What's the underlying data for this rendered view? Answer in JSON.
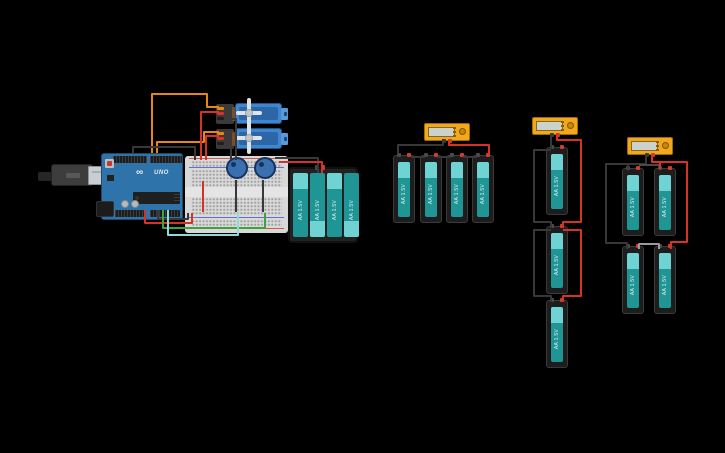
{
  "canvas": {
    "background": "#000000",
    "width": 725,
    "height": 453
  },
  "palette": {
    "wire_red": "#d63227",
    "wire_black": "#383838",
    "wire_orange": "#e8870e",
    "wire_green": "#3da43d",
    "wire_cyan": "#93d9d9",
    "wire_gray": "#9a9a9a",
    "wire_darkgray": "#4a4a4a",
    "board_blue": "#2e74ab",
    "battery_teal": "#1f9595",
    "battery_teal_light": "#6fd3d3",
    "multimeter_orange": "#f2a71d",
    "servo_blue": "#3e87cf",
    "breadboard_gray": "#d8d8d8"
  },
  "labels": {
    "battery": "AA 1.5V",
    "arduino_model": "UNO",
    "arduino_logo": "∞"
  },
  "components": {
    "arduino": {
      "name": "Arduino Uno R3",
      "model": "UNO"
    },
    "usb_cable": {
      "name": "USB cable"
    },
    "breadboard": {
      "name": "Small breadboard"
    },
    "servos": [
      {
        "name": "Micro servo 1"
      },
      {
        "name": "Micro servo 2"
      }
    ],
    "potentiometers": [
      {
        "name": "Potentiometer 1"
      },
      {
        "name": "Potentiometer 2"
      }
    ],
    "battery_pack": {
      "name": "4x AA battery pack",
      "cells": 4,
      "cell_label": "AA 1.5V"
    },
    "battery_bank": {
      "name": "4x AA batteries chained to multimeter",
      "cells": 4
    },
    "battery_stack": {
      "name": "3x AA batteries stacked in series with multimeter",
      "cells": 3
    },
    "battery_grid": {
      "name": "2x2 AA batteries with multimeter",
      "cells": 4
    },
    "multimeters": [
      {
        "name": "Multimeter 1",
        "reading": ""
      },
      {
        "name": "Multimeter 2",
        "reading": ""
      },
      {
        "name": "Multimeter 3",
        "reading": ""
      }
    ]
  }
}
